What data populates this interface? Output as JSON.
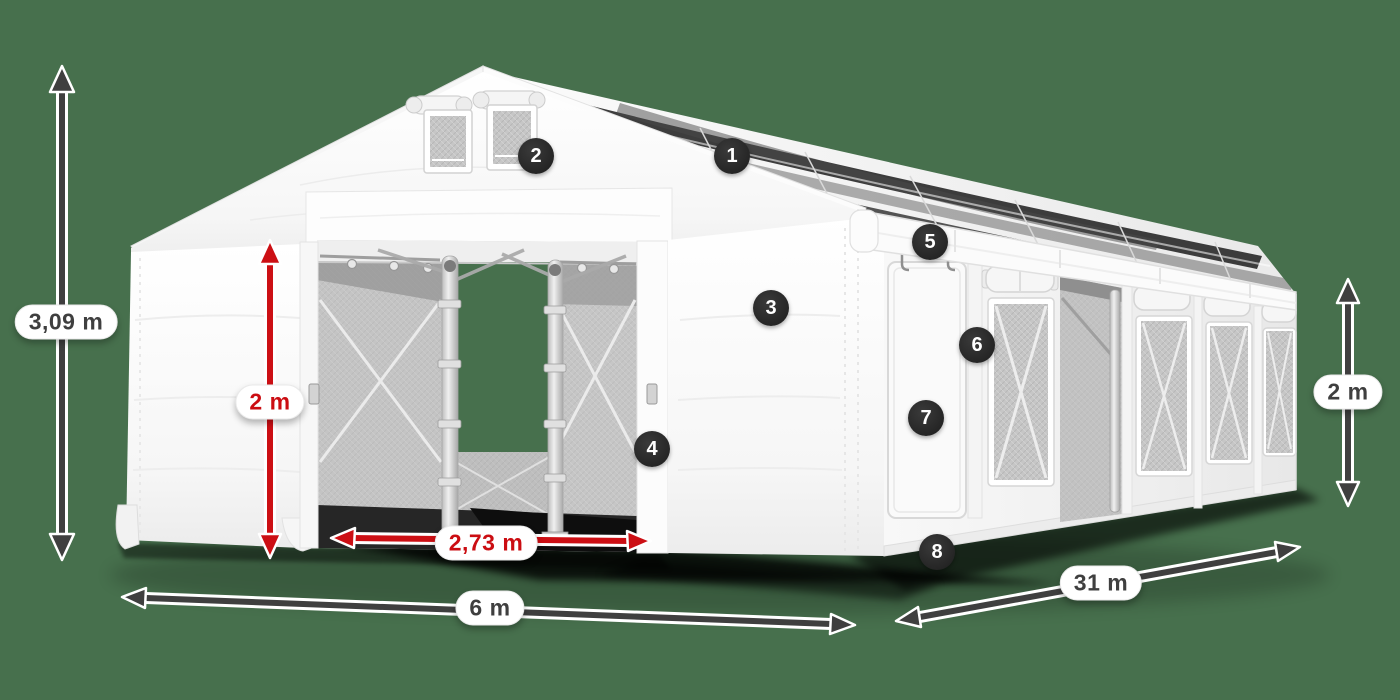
{
  "colors": {
    "background_green": "#47704d",
    "arrow_dark": "#3f3f3f",
    "arrow_red": "#cc0f14",
    "marker_background": "#2b2b2b",
    "marker_text": "#ffffff",
    "tent_white": "#ffffff"
  },
  "dimensions": {
    "total_height": {
      "label": "3,09 m"
    },
    "door_height": {
      "label": "2 m"
    },
    "door_width": {
      "label": "2,73 m"
    },
    "front_width": {
      "label": "6 m"
    },
    "side_length": {
      "label": "31 m"
    },
    "wall_height": {
      "label": "2 m"
    }
  },
  "markers": [
    {
      "number": "1"
    },
    {
      "number": "2"
    },
    {
      "number": "3"
    },
    {
      "number": "4"
    },
    {
      "number": "5"
    },
    {
      "number": "6"
    },
    {
      "number": "7"
    },
    {
      "number": "8"
    }
  ]
}
